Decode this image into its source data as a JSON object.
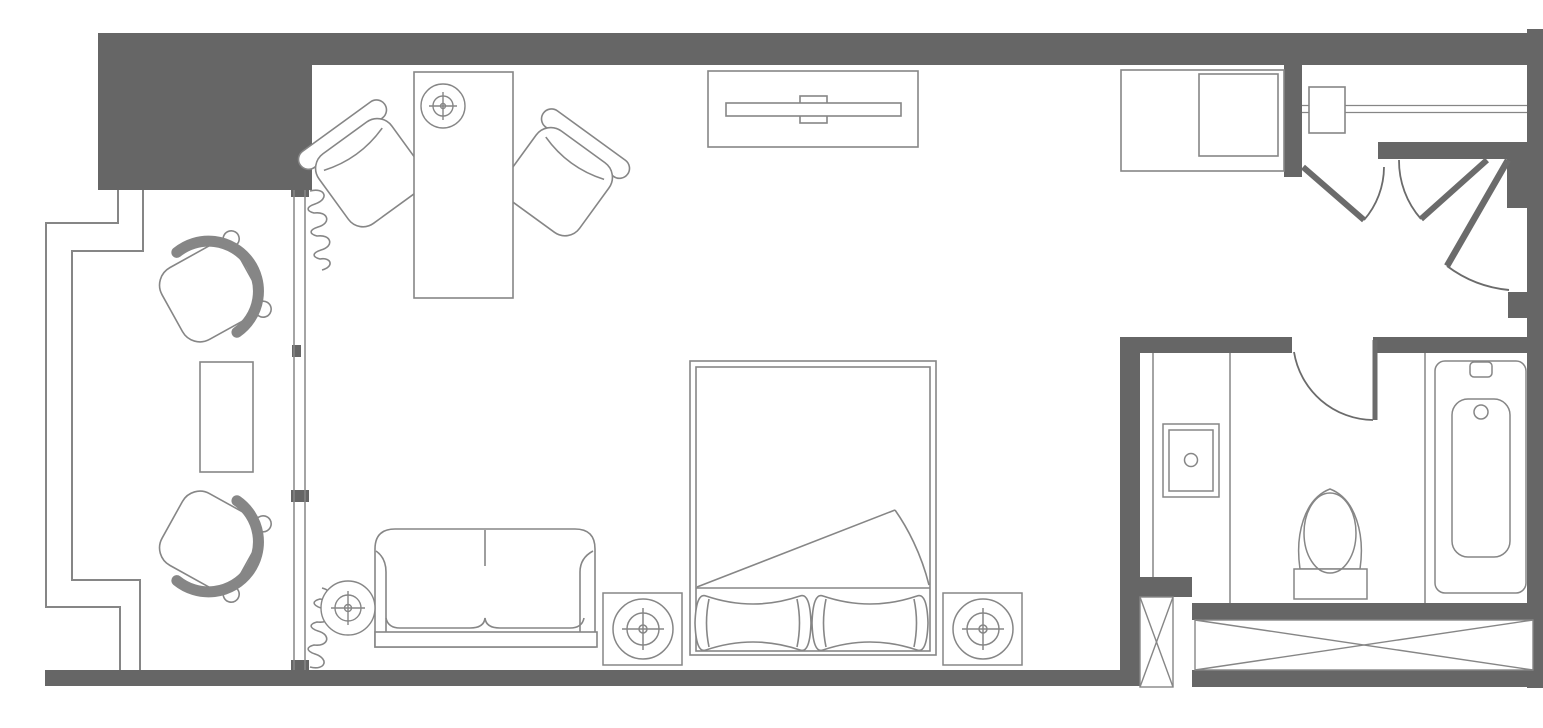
{
  "meta": {
    "title": "Hotel guest room floor plan",
    "plan_type": "architectural floor plan, top-down"
  },
  "colors": {
    "background": "#ffffff",
    "wall_fill": "#666666",
    "line": "#868686",
    "door": "#6b6b6b"
  },
  "rooms": [
    {
      "id": "balcony",
      "label": "Balcony with two lounge chairs and side table"
    },
    {
      "id": "guest-room",
      "label": "Guest room with bed, sofa, desk, TV console"
    },
    {
      "id": "entry-vestibule",
      "label": "Entry vestibule with entry door"
    },
    {
      "id": "closet",
      "label": "Closet with hanging rod and double doors"
    },
    {
      "id": "bathroom",
      "label": "Bathroom with vanity, toilet and bathtub"
    }
  ],
  "furniture": [
    {
      "id": "balcony-chair-top",
      "label": "balcony lounge chair"
    },
    {
      "id": "balcony-chair-bottom",
      "label": "balcony lounge chair"
    },
    {
      "id": "balcony-table",
      "label": "balcony side table"
    },
    {
      "id": "desk",
      "label": "writing desk"
    },
    {
      "id": "desk-lamp",
      "label": "desk lamp"
    },
    {
      "id": "desk-chair-left",
      "label": "desk chair"
    },
    {
      "id": "desk-chair-right",
      "label": "desk chair"
    },
    {
      "id": "tv-console",
      "label": "TV console with flat screen TV"
    },
    {
      "id": "minibar-cabinet",
      "label": "dresser / minibar cabinet"
    },
    {
      "id": "closet-rod",
      "label": "closet hanging rod"
    },
    {
      "id": "luggage-shelf",
      "label": "luggage shelf"
    },
    {
      "id": "sofa",
      "label": "two-seat sofa"
    },
    {
      "id": "floor-lamp",
      "label": "floor lamp"
    },
    {
      "id": "bed",
      "label": "king bed with turned-down sheet and two pillows"
    },
    {
      "id": "nightstand-left",
      "label": "nightstand with table lamp"
    },
    {
      "id": "nightstand-right",
      "label": "nightstand with table lamp"
    },
    {
      "id": "vanity-sink",
      "label": "bathroom vanity sink"
    },
    {
      "id": "toilet",
      "label": "toilet"
    },
    {
      "id": "bathtub",
      "label": "bathtub"
    },
    {
      "id": "duct-shaft",
      "label": "shaft / chase (crossed box)"
    },
    {
      "id": "linen-shelf",
      "label": "built-in shelf (crossed box)"
    },
    {
      "id": "window-wall",
      "label": "sliding glass balcony door"
    },
    {
      "id": "curtains",
      "label": "curtains"
    },
    {
      "id": "entry-door",
      "label": "entry door swing"
    },
    {
      "id": "closet-doors",
      "label": "closet double door swing"
    },
    {
      "id": "bathroom-door",
      "label": "bathroom door swing"
    }
  ]
}
